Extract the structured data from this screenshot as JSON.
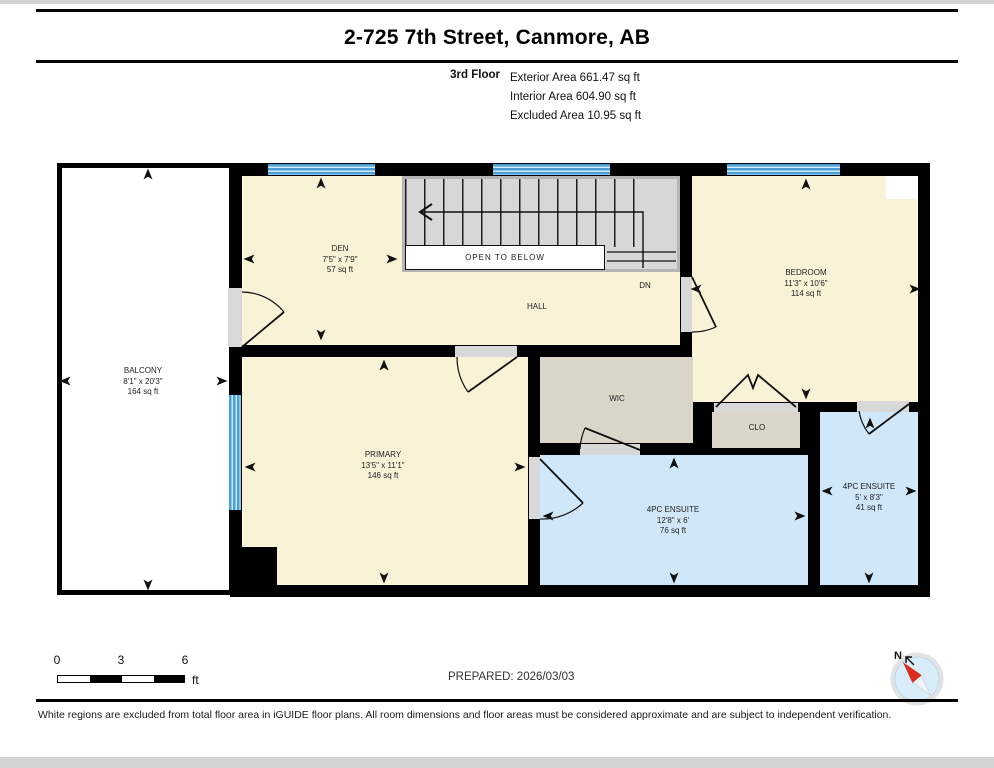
{
  "header": {
    "title": "2-725 7th Street, Canmore, AB",
    "floor_label": "3rd Floor",
    "area_lines": [
      "Exterior Area 661.47 sq ft",
      "Interior Area 604.90 sq ft",
      "Excluded Area 10.95 sq ft"
    ]
  },
  "rooms": {
    "balcony": {
      "name": "BALCONY",
      "dims": "8'1\" x 20'3\"",
      "area": "164 sq ft"
    },
    "den": {
      "name": "DEN",
      "dims": "7'5\" x 7'9\"",
      "area": "57 sq ft"
    },
    "hall": {
      "name": "HALL"
    },
    "bedroom": {
      "name": "BEDROOM",
      "dims": "11'3\" x 10'6\"",
      "area": "114 sq ft"
    },
    "primary": {
      "name": "PRIMARY",
      "dims": "13'5\" x 11'1\"",
      "area": "146 sq ft"
    },
    "wic": {
      "name": "WIC"
    },
    "clo": {
      "name": "CLO"
    },
    "ensuite_main": {
      "name": "4PC ENSUITE",
      "dims": "12'8\" x 6'",
      "area": "76 sq ft"
    },
    "ensuite_small": {
      "name": "4PC ENSUITE",
      "dims": "5' x 8'3\"",
      "area": "41 sq ft"
    }
  },
  "stairs": {
    "open_to_below": "OPEN TO BELOW",
    "down_label": "DN"
  },
  "scale_bar": {
    "ticks": [
      "0",
      "3",
      "6"
    ],
    "unit": "ft"
  },
  "prepared": "PREPARED: 2026/03/03",
  "compass": {
    "north_label": "N"
  },
  "footer": "White regions are excluded from total floor area in iGUIDE floor plans. All room dimensions and floor areas must be considered approximate and are subject to independent verification.",
  "colors": {
    "room_fill": "#f9f2d6",
    "wet_fill": "#cfe7f8",
    "closet_fill": "#dbd5c9",
    "stairs_fill": "#d7d7d7",
    "window_blue": "#4aa0d6",
    "door_grey": "#d8d8d8",
    "wall": "#000000"
  }
}
